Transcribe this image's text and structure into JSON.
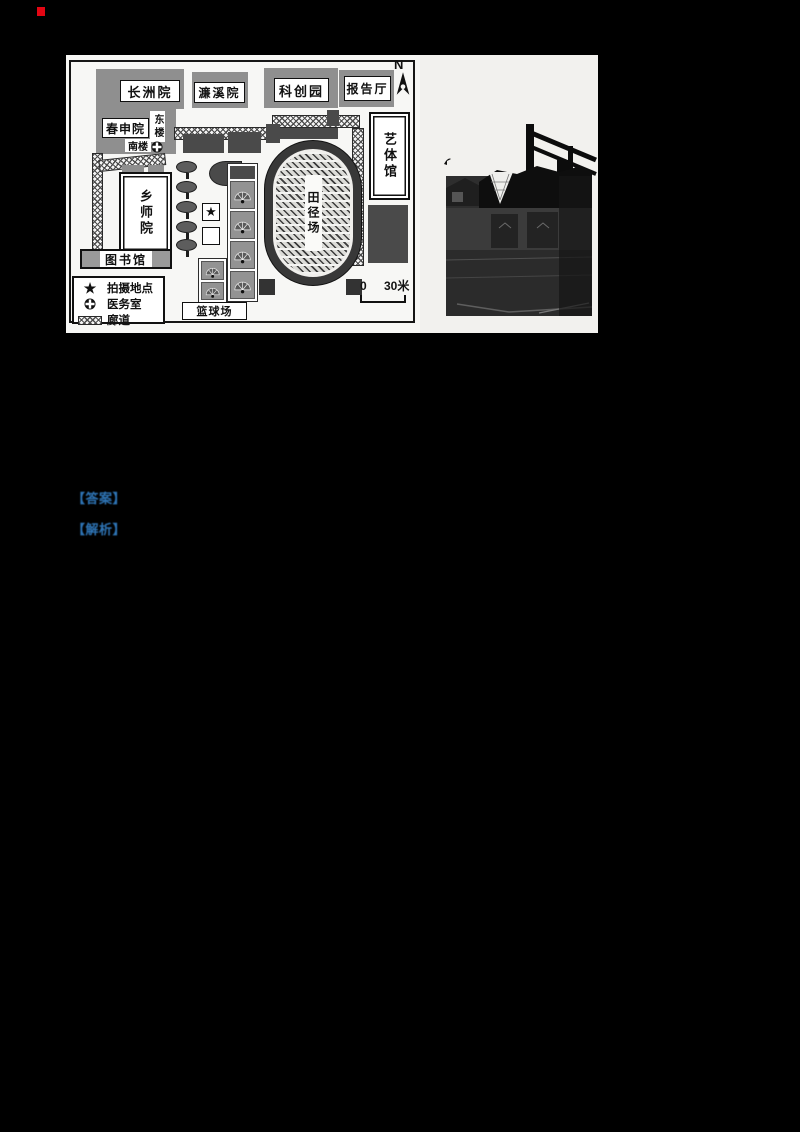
{
  "page": {
    "background": "#000000",
    "artifact_color": "#e30613"
  },
  "map": {
    "compass": "N",
    "buildings": {
      "changzhou": "长洲院",
      "lianxi": "濂溪院",
      "kechuang": "科创园",
      "baogao": "报告厅",
      "chunshen": "春申院",
      "donglou": "东楼",
      "nanlou": "南楼",
      "xiangshi": "乡师院",
      "library": "图书馆",
      "yiti": "艺体馆",
      "track": "田径场",
      "basketball": "篮球场"
    },
    "legend": {
      "star_icon": "★",
      "photo_spot": "拍摄地点",
      "medical": "医务室",
      "corridor": "廊道"
    },
    "scale": {
      "zero": "0",
      "distance": "30米"
    }
  },
  "annotations": {
    "answer_label": "【答案】",
    "analysis_label": "【解析】",
    "color": "#2e74b5"
  }
}
